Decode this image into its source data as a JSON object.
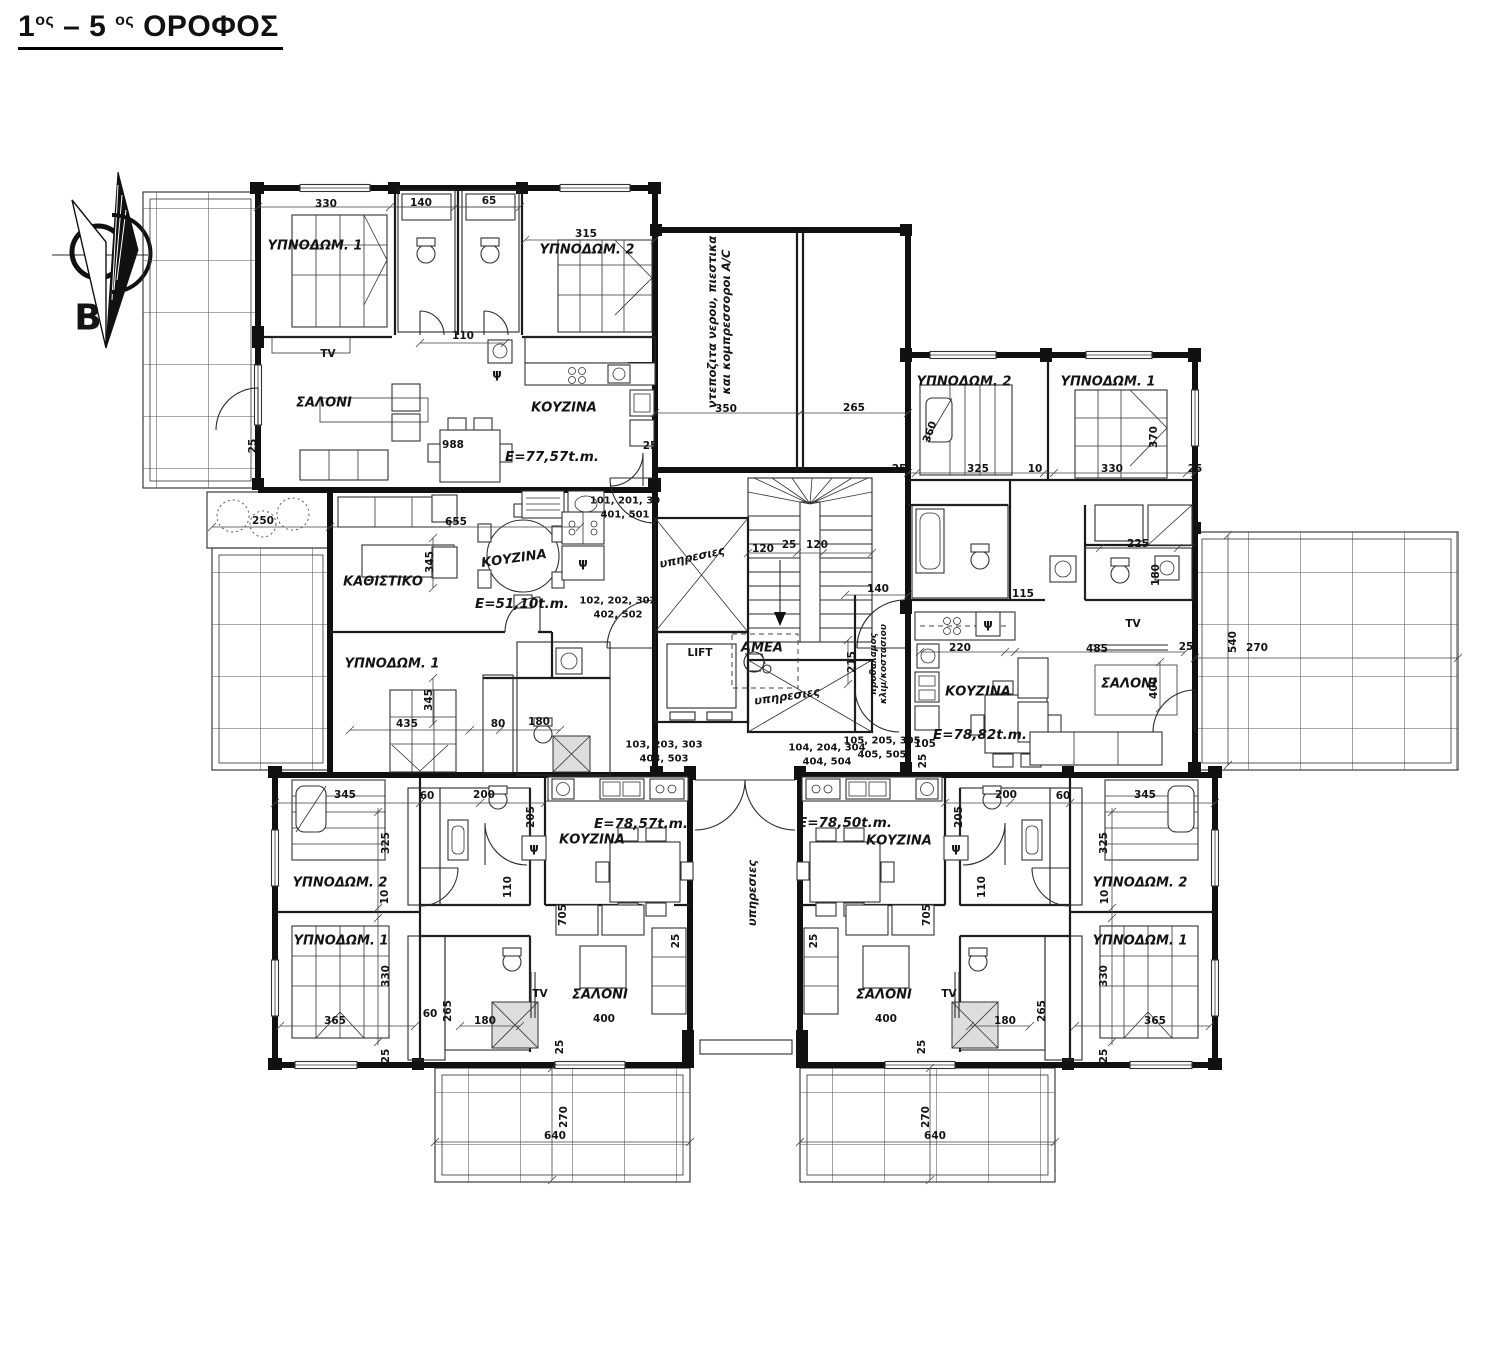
{
  "title": {
    "p1": "1",
    "s1": "ος",
    "p2": " – 5 ",
    "s2": "ος",
    "p3": " ΟΡΟΦΟΣ"
  },
  "plan": {
    "labels": [
      {
        "n": "north-label",
        "t": "B",
        "x": 88,
        "y": 318,
        "c": "north"
      },
      {
        "n": "room-bedroom1-top-left",
        "t": "ΥΠΝΟΔΩΜ. 1",
        "x": 315,
        "y": 246,
        "c": "room"
      },
      {
        "n": "room-bedroom2-top-left",
        "t": "ΥΠΝΟΔΩΜ. 2",
        "x": 587,
        "y": 250,
        "c": "room"
      },
      {
        "n": "room-living-top-left",
        "t": "ΣΑΛΟΝΙ",
        "x": 324,
        "y": 403,
        "c": "room"
      },
      {
        "n": "room-kitchen-top-left",
        "t": "ΚΟΥΖΙΝΑ",
        "x": 564,
        "y": 408,
        "c": "room"
      },
      {
        "n": "room-sitting-mid-left",
        "t": "ΚΑΘΙΣΤΙΚΟ",
        "x": 383,
        "y": 582,
        "c": "room"
      },
      {
        "n": "room-kitchen-center",
        "t": "ΚΟΥΖΙΝΑ",
        "x": 514,
        "y": 559,
        "r": -8,
        "c": "room"
      },
      {
        "n": "room-bedroom1-mid-left",
        "t": "ΥΠΝΟΔΩΜ. 1",
        "x": 392,
        "y": 664,
        "c": "room"
      },
      {
        "n": "room-bedroom2-top-right",
        "t": "ΥΠΝΟΔΩΜ. 2",
        "x": 964,
        "y": 382,
        "c": "room"
      },
      {
        "n": "room-bedroom1-top-right",
        "t": "ΥΠΝΟΔΩΜ. 1",
        "x": 1108,
        "y": 382,
        "c": "room"
      },
      {
        "n": "room-kitchen-right",
        "t": "ΚΟΥΖΙΝΑ",
        "x": 978,
        "y": 692,
        "c": "room"
      },
      {
        "n": "room-living-right",
        "t": "ΣΑΛΟΝΙ",
        "x": 1129,
        "y": 684,
        "c": "room"
      },
      {
        "n": "room-bedroom2-bottom-left",
        "t": "ΥΠΝΟΔΩΜ. 2",
        "x": 340,
        "y": 883,
        "c": "room"
      },
      {
        "n": "room-bedroom1-bottom-left",
        "t": "ΥΠΝΟΔΩΜ. 1",
        "x": 341,
        "y": 941,
        "c": "room"
      },
      {
        "n": "room-kitchen-bottom-left",
        "t": "ΚΟΥΖΙΝΑ",
        "x": 592,
        "y": 840,
        "c": "room"
      },
      {
        "n": "room-living-bottom-left",
        "t": "ΣΑΛΟΝΙ",
        "x": 600,
        "y": 995,
        "c": "room"
      },
      {
        "n": "room-kitchen-bottom-right",
        "t": "ΚΟΥΖΙΝΑ",
        "x": 899,
        "y": 841,
        "c": "room"
      },
      {
        "n": "room-living-bottom-right",
        "t": "ΣΑΛΟΝΙ",
        "x": 884,
        "y": 995,
        "c": "room"
      },
      {
        "n": "room-bedroom2-bottom-right",
        "t": "ΥΠΝΟΔΩΜ. 2",
        "x": 1140,
        "y": 883,
        "c": "room"
      },
      {
        "n": "room-bedroom1-bottom-right",
        "t": "ΥΠΝΟΔΩΜ. 1",
        "x": 1140,
        "y": 941,
        "c": "room"
      },
      {
        "n": "area-apt-101",
        "t": "E=77,57t.m.",
        "x": 552,
        "y": 457,
        "c": "area"
      },
      {
        "n": "area-apt-102",
        "t": "E=51,10t.m.",
        "x": 522,
        "y": 604,
        "c": "area"
      },
      {
        "n": "area-apt-105",
        "t": "E=78,82t.m.",
        "x": 980,
        "y": 735,
        "c": "area"
      },
      {
        "n": "area-apt-103",
        "t": "E=78,57t.m.",
        "x": 641,
        "y": 824,
        "c": "area"
      },
      {
        "n": "area-apt-104",
        "t": "E=78,50t.m.",
        "x": 845,
        "y": 823,
        "c": "area"
      },
      {
        "n": "apt-numbers-101",
        "t": "101, 201, 30\n401, 501",
        "x": 625,
        "y": 508,
        "c": "apt"
      },
      {
        "n": "apt-numbers-102",
        "t": "102, 202, 302\n402, 502",
        "x": 618,
        "y": 608,
        "c": "apt"
      },
      {
        "n": "apt-numbers-103",
        "t": "103, 203, 303\n403, 503",
        "x": 664,
        "y": 752,
        "c": "apt"
      },
      {
        "n": "apt-numbers-104",
        "t": "104, 204, 304\n404, 504",
        "x": 827,
        "y": 755,
        "c": "apt"
      },
      {
        "n": "apt-numbers-105",
        "t": "105, 205, 305\n405, 505",
        "x": 882,
        "y": 748,
        "c": "apt"
      },
      {
        "n": "utility-zone-note",
        "t": "ντεποζιτα νερου, πιεστικα\nκαι κομπρεσσοροι A/C",
        "x": 719,
        "y": 322,
        "r": -90,
        "c": "vtxt"
      },
      {
        "n": "shaft-label-upper",
        "t": "υπηρεσιες",
        "x": 692,
        "y": 557,
        "r": -12,
        "c": "vtxt"
      },
      {
        "n": "shaft-label-lower",
        "t": "υπηρεσιες",
        "x": 787,
        "y": 696,
        "r": -8,
        "c": "vtxt"
      },
      {
        "n": "corridor-label",
        "t": "υπηρεσιες",
        "x": 752,
        "y": 893,
        "r": -90,
        "c": "vtxt"
      },
      {
        "n": "stair-lobby-label",
        "t": "προθαλαμος\nκλιμ/κοστασιου",
        "x": 879,
        "y": 664,
        "r": -90,
        "c": "tiny"
      },
      {
        "n": "lift-label",
        "t": "LIFT",
        "x": 700,
        "y": 653,
        "c": "fix"
      },
      {
        "n": "amea-label",
        "t": "ΑΜΕΑ",
        "x": 762,
        "y": 648,
        "c": "room"
      },
      {
        "n": "tv-top-left",
        "t": "TV",
        "x": 328,
        "y": 354,
        "c": "fix"
      },
      {
        "n": "tv-right",
        "t": "TV",
        "x": 1133,
        "y": 624,
        "c": "fix"
      },
      {
        "n": "tv-bottom-left",
        "t": "TV",
        "x": 540,
        "y": 994,
        "c": "fix"
      },
      {
        "n": "tv-bottom-right",
        "t": "TV",
        "x": 949,
        "y": 994,
        "c": "fix"
      },
      {
        "n": "psi-top-left",
        "t": "ψ",
        "x": 497,
        "y": 374,
        "c": "psi"
      },
      {
        "n": "psi-mid-left",
        "t": "ψ",
        "x": 583,
        "y": 563,
        "c": "psi"
      },
      {
        "n": "psi-right",
        "t": "ψ",
        "x": 988,
        "y": 624,
        "c": "psi"
      },
      {
        "n": "psi-bottom-left",
        "t": "ψ",
        "x": 534,
        "y": 848,
        "c": "psi"
      },
      {
        "n": "psi-bottom-right",
        "t": "ψ",
        "x": 956,
        "y": 848,
        "c": "psi"
      },
      {
        "n": "dim-330-top-left",
        "t": "330",
        "x": 326,
        "y": 204,
        "c": "dim"
      },
      {
        "n": "dim-140-top-left",
        "t": "140",
        "x": 421,
        "y": 203,
        "c": "dim"
      },
      {
        "n": "dim-65-top-left",
        "t": "65",
        "x": 489,
        "y": 201,
        "c": "dim"
      },
      {
        "n": "dim-315-top-left",
        "t": "315",
        "x": 586,
        "y": 234,
        "c": "dim"
      },
      {
        "n": "dim-110-top-left",
        "t": "110",
        "x": 463,
        "y": 336,
        "c": "dim"
      },
      {
        "n": "dim-988-top-left",
        "t": "988",
        "x": 453,
        "y": 445,
        "c": "dim"
      },
      {
        "n": "dim-25-tl-left",
        "t": "25",
        "x": 253,
        "y": 446,
        "r": -90,
        "c": "dim"
      },
      {
        "n": "dim-25-tl-right",
        "t": "25",
        "x": 650,
        "y": 446,
        "c": "dim"
      },
      {
        "n": "dim-350-utility",
        "t": "350",
        "x": 726,
        "y": 409,
        "c": "dim"
      },
      {
        "n": "dim-265-utility",
        "t": "265",
        "x": 854,
        "y": 408,
        "c": "dim"
      },
      {
        "n": "dim-250-planter",
        "t": "250",
        "x": 263,
        "y": 521,
        "c": "dim"
      },
      {
        "n": "dim-655-mid",
        "t": "655",
        "x": 456,
        "y": 522,
        "c": "dim"
      },
      {
        "n": "dim-345-mid-upper",
        "t": "345",
        "x": 430,
        "y": 562,
        "r": -90,
        "c": "dim"
      },
      {
        "n": "dim-120-stair-left",
        "t": "120",
        "x": 763,
        "y": 549,
        "c": "dim"
      },
      {
        "n": "dim-25-stair",
        "t": "25",
        "x": 789,
        "y": 545,
        "c": "dim"
      },
      {
        "n": "dim-120-stair-right",
        "t": "120",
        "x": 817,
        "y": 545,
        "c": "dim"
      },
      {
        "n": "dim-140-core",
        "t": "140",
        "x": 878,
        "y": 589,
        "c": "dim"
      },
      {
        "n": "dim-215-core",
        "t": "215",
        "x": 852,
        "y": 662,
        "r": -90,
        "c": "dim"
      },
      {
        "n": "dim-345-mid-lower",
        "t": "345",
        "x": 429,
        "y": 700,
        "r": -90,
        "c": "dim"
      },
      {
        "n": "dim-435-mid",
        "t": "435",
        "x": 407,
        "y": 724,
        "c": "dim"
      },
      {
        "n": "dim-80-mid",
        "t": "80",
        "x": 498,
        "y": 724,
        "c": "dim"
      },
      {
        "n": "dim-180-mid",
        "t": "180",
        "x": 539,
        "y": 722,
        "c": "dim"
      },
      {
        "n": "dim-360-top-right",
        "t": "360",
        "x": 930,
        "y": 432,
        "r": -70,
        "c": "dim"
      },
      {
        "n": "dim-370-top-right",
        "t": "370",
        "x": 1154,
        "y": 437,
        "r": -90,
        "c": "dim"
      },
      {
        "n": "dim-25-tr-1",
        "t": "25",
        "x": 899,
        "y": 469,
        "c": "dim"
      },
      {
        "n": "dim-325-top-right",
        "t": "325",
        "x": 978,
        "y": 469,
        "c": "dim"
      },
      {
        "n": "dim-10-top-right",
        "t": "10",
        "x": 1035,
        "y": 469,
        "c": "dim"
      },
      {
        "n": "dim-330-top-right",
        "t": "330",
        "x": 1112,
        "y": 469,
        "c": "dim"
      },
      {
        "n": "dim-25-tr-2",
        "t": "25",
        "x": 1195,
        "y": 469,
        "c": "dim"
      },
      {
        "n": "dim-225-right",
        "t": "225",
        "x": 1138,
        "y": 544,
        "c": "dim"
      },
      {
        "n": "dim-180-right",
        "t": "180",
        "x": 1156,
        "y": 575,
        "r": -90,
        "c": "dim"
      },
      {
        "n": "dim-115-right",
        "t": "115",
        "x": 1023,
        "y": 594,
        "c": "dim"
      },
      {
        "n": "dim-220-right",
        "t": "220",
        "x": 960,
        "y": 648,
        "c": "dim"
      },
      {
        "n": "dim-485-right",
        "t": "485",
        "x": 1097,
        "y": 649,
        "c": "dim"
      },
      {
        "n": "dim-25-right",
        "t": "25",
        "x": 1186,
        "y": 647,
        "c": "dim"
      },
      {
        "n": "dim-400-right",
        "t": "400",
        "x": 1154,
        "y": 688,
        "r": -90,
        "c": "dim"
      },
      {
        "n": "dim-105-right",
        "t": "105",
        "x": 925,
        "y": 744,
        "c": "dim"
      },
      {
        "n": "dim-25-right-2",
        "t": "25",
        "x": 923,
        "y": 761,
        "r": -90,
        "c": "dim"
      },
      {
        "n": "dim-540-balcony-right",
        "t": "540",
        "x": 1233,
        "y": 642,
        "r": -90,
        "c": "dim"
      },
      {
        "n": "dim-270-balcony-right",
        "t": "270",
        "x": 1257,
        "y": 648,
        "c": "dim"
      },
      {
        "n": "dim-345-bottom-left",
        "t": "345",
        "x": 345,
        "y": 795,
        "c": "dim"
      },
      {
        "n": "dim-60-bottom-left",
        "t": "60",
        "x": 427,
        "y": 796,
        "c": "dim"
      },
      {
        "n": "dim-200-bottom-left",
        "t": "200",
        "x": 484,
        "y": 795,
        "c": "dim"
      },
      {
        "n": "dim-205-bottom-left",
        "t": "205",
        "x": 531,
        "y": 817,
        "r": -90,
        "c": "dim"
      },
      {
        "n": "dim-325-bl",
        "t": "325",
        "x": 386,
        "y": 843,
        "r": -90,
        "c": "dim"
      },
      {
        "n": "dim-10-bl",
        "t": "10",
        "x": 385,
        "y": 897,
        "r": -90,
        "c": "dim"
      },
      {
        "n": "dim-110-bl",
        "t": "110",
        "x": 508,
        "y": 887,
        "r": -90,
        "c": "dim"
      },
      {
        "n": "dim-705-bl",
        "t": "705",
        "x": 563,
        "y": 915,
        "r": -90,
        "c": "dim"
      },
      {
        "n": "dim-330-bl",
        "t": "330",
        "x": 386,
        "y": 976,
        "r": -90,
        "c": "dim"
      },
      {
        "n": "dim-365-bl",
        "t": "365",
        "x": 335,
        "y": 1021,
        "c": "dim"
      },
      {
        "n": "dim-60-bl-2",
        "t": "60",
        "x": 430,
        "y": 1014,
        "c": "dim"
      },
      {
        "n": "dim-265-bl",
        "t": "265",
        "x": 448,
        "y": 1011,
        "r": -90,
        "c": "dim"
      },
      {
        "n": "dim-180-bl",
        "t": "180",
        "x": 485,
        "y": 1021,
        "c": "dim"
      },
      {
        "n": "dim-400-bl",
        "t": "400",
        "x": 604,
        "y": 1019,
        "c": "dim"
      },
      {
        "n": "dim-25-bl",
        "t": "25",
        "x": 560,
        "y": 1047,
        "r": -90,
        "c": "dim"
      },
      {
        "n": "dim-25-bl-2",
        "t": "25",
        "x": 676,
        "y": 941,
        "r": -90,
        "c": "dim"
      },
      {
        "n": "dim-25-bl-3",
        "t": "25",
        "x": 386,
        "y": 1056,
        "r": -90,
        "c": "dim"
      },
      {
        "n": "dim-270-balcony-bl",
        "t": "270",
        "x": 564,
        "y": 1117,
        "r": -90,
        "c": "dim"
      },
      {
        "n": "dim-640-balcony-bl",
        "t": "640",
        "x": 555,
        "y": 1136,
        "c": "dim"
      },
      {
        "n": "dim-270-balcony-br",
        "t": "270",
        "x": 926,
        "y": 1117,
        "r": -90,
        "c": "dim"
      },
      {
        "n": "dim-640-balcony-br",
        "t": "640",
        "x": 935,
        "y": 1136,
        "c": "dim"
      },
      {
        "n": "dim-25-br",
        "t": "25",
        "x": 922,
        "y": 1047,
        "r": -90,
        "c": "dim"
      },
      {
        "n": "dim-200-bottom-right",
        "t": "200",
        "x": 1006,
        "y": 795,
        "c": "dim"
      },
      {
        "n": "dim-60-bottom-right",
        "t": "60",
        "x": 1063,
        "y": 796,
        "c": "dim"
      },
      {
        "n": "dim-345-bottom-right",
        "t": "345",
        "x": 1145,
        "y": 795,
        "c": "dim"
      },
      {
        "n": "dim-205-bottom-right",
        "t": "205",
        "x": 959,
        "y": 817,
        "r": -90,
        "c": "dim"
      },
      {
        "n": "dim-325-br",
        "t": "325",
        "x": 1104,
        "y": 843,
        "r": -90,
        "c": "dim"
      },
      {
        "n": "dim-10-br",
        "t": "10",
        "x": 1105,
        "y": 897,
        "r": -90,
        "c": "dim"
      },
      {
        "n": "dim-330-br",
        "t": "330",
        "x": 1104,
        "y": 976,
        "r": -90,
        "c": "dim"
      },
      {
        "n": "dim-365-br",
        "t": "365",
        "x": 1155,
        "y": 1021,
        "c": "dim"
      },
      {
        "n": "dim-180-br",
        "t": "180",
        "x": 1005,
        "y": 1021,
        "c": "dim"
      },
      {
        "n": "dim-265-br",
        "t": "265",
        "x": 1042,
        "y": 1011,
        "r": -90,
        "c": "dim"
      },
      {
        "n": "dim-400-br",
        "t": "400",
        "x": 886,
        "y": 1019,
        "c": "dim"
      },
      {
        "n": "dim-110-br",
        "t": "110",
        "x": 982,
        "y": 887,
        "r": -90,
        "c": "dim"
      },
      {
        "n": "dim-705-br",
        "t": "705",
        "x": 927,
        "y": 915,
        "r": -90,
        "c": "dim"
      },
      {
        "n": "dim-25-br-2",
        "t": "25",
        "x": 814,
        "y": 941,
        "r": -90,
        "c": "dim"
      },
      {
        "n": "dim-25-br-3",
        "t": "25",
        "x": 1104,
        "y": 1056,
        "r": -90,
        "c": "dim"
      }
    ]
  }
}
